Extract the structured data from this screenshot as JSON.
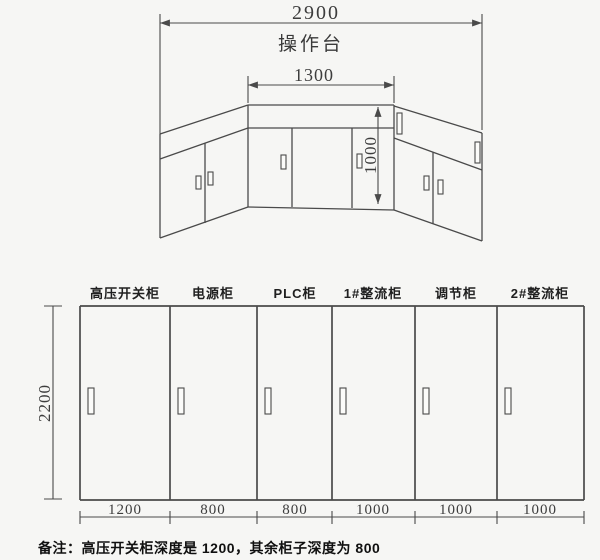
{
  "console": {
    "title": "操作台",
    "total_width_mm": "2900",
    "center_width_mm": "1300",
    "depth_mm": "1000"
  },
  "cabinets": {
    "height_mm": "2200",
    "items": [
      {
        "label": "高压开关柜",
        "width_mm": "1200"
      },
      {
        "label": "电源柜",
        "width_mm": "800"
      },
      {
        "label": "PLC柜",
        "width_mm": "800"
      },
      {
        "label": "1#整流柜",
        "width_mm": "1000"
      },
      {
        "label": "调节柜",
        "width_mm": "1000"
      },
      {
        "label": "2#整流柜",
        "width_mm": "1000"
      }
    ]
  },
  "note": {
    "text": "备注：高压开关柜深度是 1200，其余柜子深度为 800"
  },
  "colors": {
    "background": "#f6f6f4",
    "line": "#4a4a4a",
    "dimension_text": "#3d3d3d",
    "label_text": "#202020",
    "note_text": "#101010"
  }
}
